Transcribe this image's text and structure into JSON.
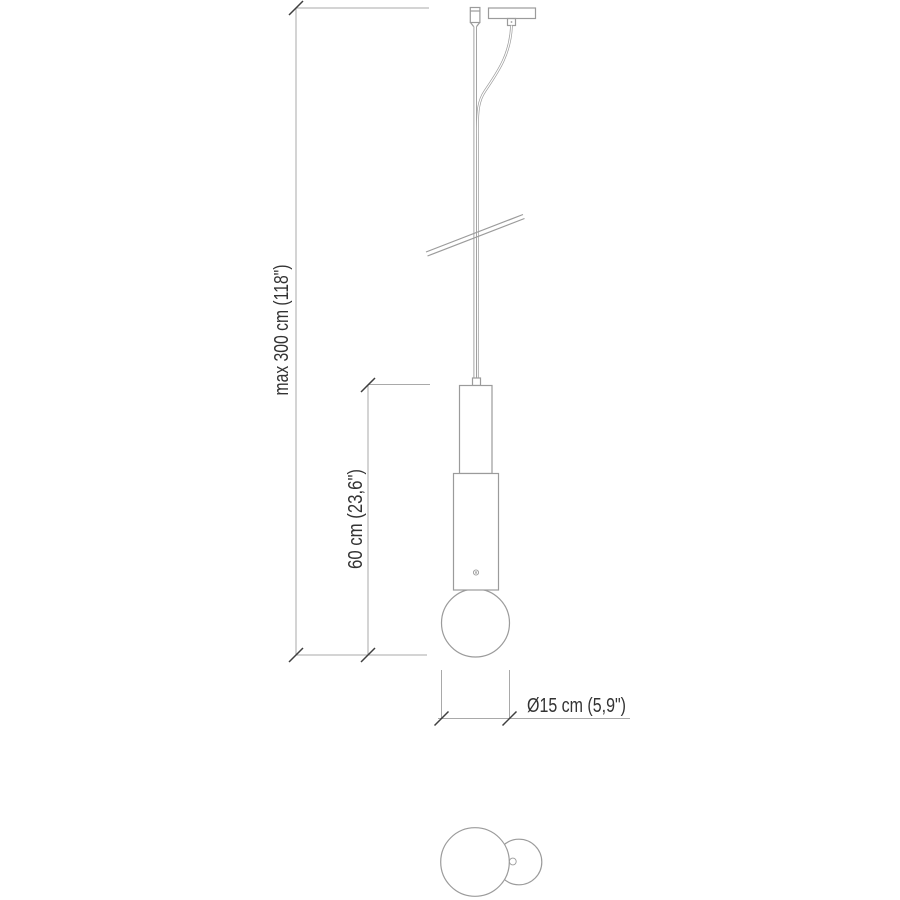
{
  "drawing": {
    "kind": "pendant-lamp-technical-dimension-drawing",
    "views": {
      "front_view": "pendant lamp with ceiling canopy, suspension cable, cylindrical body and sphere diffuser",
      "top_view": "sphere diffuser with canopy circle"
    }
  },
  "labels": {
    "max_height": "max 300 cm (118\")",
    "body_height": "60 cm (23,6\")",
    "diameter": "Ø15 cm (5,9\")"
  },
  "dimensions": {
    "max_height_cm": 300,
    "max_height_in": 118,
    "body_height_cm": 60,
    "body_height_in": 23.6,
    "diameter_cm": 15,
    "diameter_in": 5.9
  },
  "colors": {
    "outline": "#9b9b9b",
    "dimension_line": "#a9a9a9",
    "tick": "#3f3f3f",
    "text": "#333333",
    "background": "#ffffff"
  }
}
